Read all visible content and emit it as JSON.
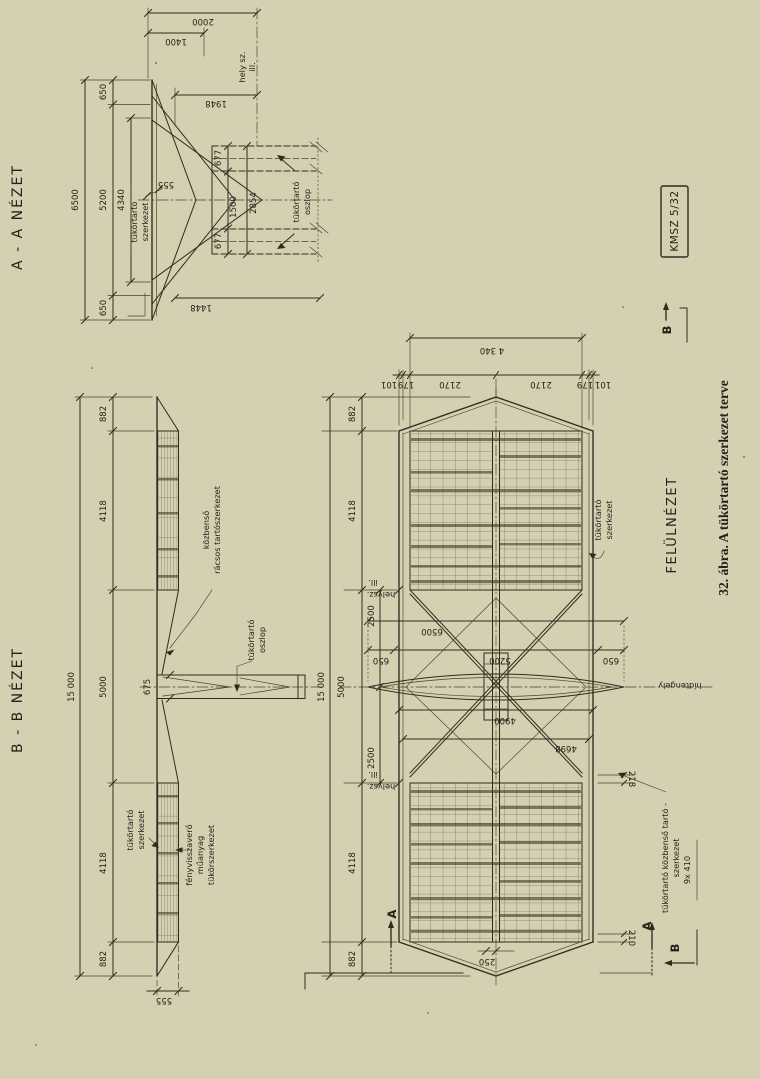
{
  "colors": {
    "paper": "#d5d0b1",
    "ink": "#2e2c21"
  },
  "caption": "32. ábra. A tükörtartó szerkezet terve",
  "stamp": "KMSZ 5/32",
  "markers": {
    "a1": "A",
    "a2": "A",
    "b_top": "B",
    "b_bottom": "B"
  },
  "view_aa": {
    "title": "A - A  NÉZET",
    "labels": {
      "site1": "hely sz.",
      "site2": "ill.",
      "mirror1": "tükörtartó",
      "mirror2": "szerkezet",
      "column1": "tükörtartó",
      "column2": "oszlop"
    },
    "dims": {
      "overall": "6500",
      "edge_top": "650",
      "mid": "5200",
      "edge_bot": "650",
      "mirror": "4340",
      "offset": "555",
      "top1": "2000",
      "top2": "1400",
      "top3": "1948",
      "bottom": "1448",
      "leg1": "677",
      "gap": "1500",
      "leg2": "677",
      "legs": "2854"
    }
  },
  "view_bb": {
    "title": "B - B  NÉZET",
    "labels": {
      "lattice1": "közbenső",
      "lattice2": "rácsos tartószerkezet",
      "column1": "tükörtartó",
      "column2": "oszlop",
      "mirror1": "tükörtartó",
      "mirror2": "szerkezet",
      "refl1": "fényvisszaverő",
      "refl2": "műanyag",
      "refl3": "tükörszerkezet"
    },
    "dims": {
      "overall": "15 000",
      "tip1": "882",
      "panel1": "4118",
      "mid": "5000",
      "panel2": "4118",
      "tip2": "882",
      "offset": "555",
      "column": "675"
    }
  },
  "view_plan": {
    "title": "FELÜLNÉZET",
    "labels": {
      "mirror1": "tükörtartó",
      "mirror2": "szerkezet",
      "axis": "hídtengely",
      "joint1a": "ill.",
      "joint1b": "helysz.",
      "joint2a": "ill.",
      "joint2b": "helysz.",
      "inter1": "tükörtartó közbenső tartó -",
      "inter2": "szerkezet",
      "inter3": "9x 410"
    },
    "dims": {
      "across": "4 340",
      "s101a": "101",
      "s179a": "179",
      "s2170a": "2170",
      "s2170b": "2170",
      "s179b": "179",
      "s101b": "101",
      "l882a": "882",
      "l4118a": "4118",
      "l5000": "5000",
      "l4118b": "4118",
      "l882b": "882",
      "l15000": "15 000",
      "c2500a": "2500",
      "c2500b": "2500",
      "deck": "6500",
      "deck650a": "650",
      "deck5200": "5200",
      "deck650b": "650",
      "w4900": "4900",
      "diag": "4698",
      "o218": "218",
      "o210": "210",
      "tip": "250"
    }
  }
}
